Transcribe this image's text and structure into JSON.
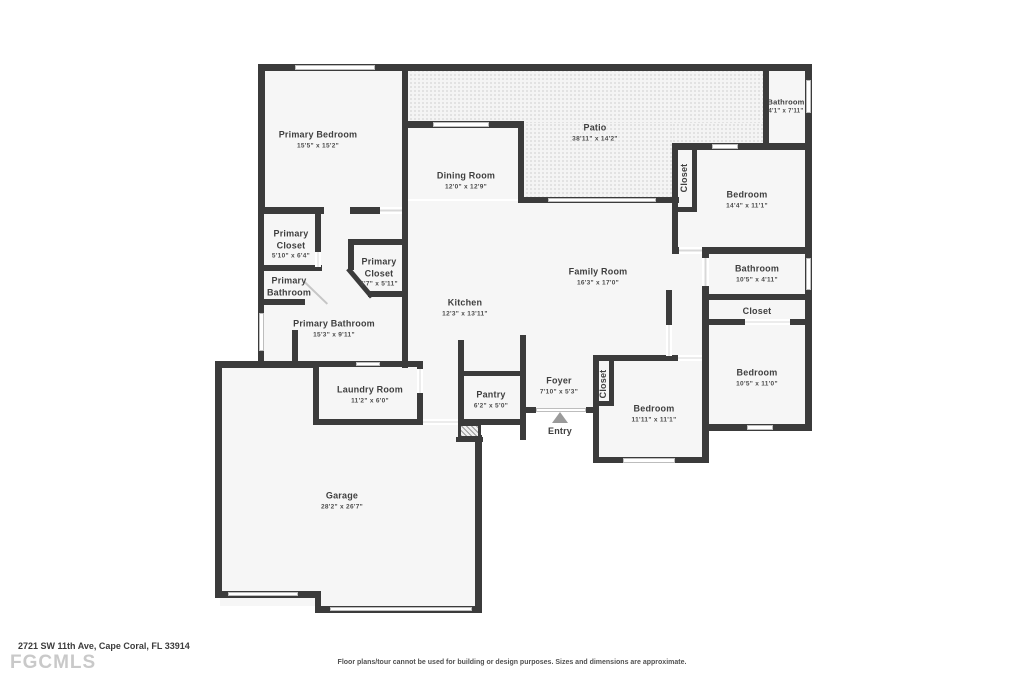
{
  "footer": {
    "address": "2721 SW 11th Ave, Cape Coral, FL 33914",
    "logo": "FGCMLS",
    "disclaimer": "Floor plans/tour cannot be used for building or design purposes. Sizes and dimensions are approximate."
  },
  "entry": {
    "label": "Entry"
  },
  "rooms": {
    "primary_bedroom": {
      "name": "Primary Bedroom",
      "dims": "15'5\" x 15'2\""
    },
    "patio": {
      "name": "Patio",
      "dims": "38'11\" x 14'2\""
    },
    "dining_room": {
      "name": "Dining Room",
      "dims": "12'0\" x 12'9\""
    },
    "bathroom_top_right": {
      "name": "Bathroom",
      "dims": "4'1\" x 7'11\""
    },
    "closet_top_right": {
      "name": "Closet"
    },
    "bedroom_top_right": {
      "name": "Bedroom",
      "dims": "14'4\" x 11'1\""
    },
    "family_room": {
      "name": "Family Room",
      "dims": "16'3\" x 17'0\""
    },
    "bathroom_right": {
      "name": "Bathroom",
      "dims": "10'5\" x 4'11\""
    },
    "closet_right": {
      "name": "Closet"
    },
    "bedroom_right": {
      "name": "Bedroom",
      "dims": "10'5\" x 11'0\""
    },
    "kitchen": {
      "name": "Kitchen",
      "dims": "12'3\" x 13'11\""
    },
    "primary_closet_left": {
      "name": "Primary Closet",
      "dims": "5'10\" x 6'4\""
    },
    "primary_bathroom_wc": {
      "name": "Primary Bathroom"
    },
    "primary_closet_right": {
      "name": "Primary Closet",
      "dims": "5'7\" x 5'11\""
    },
    "primary_bathroom": {
      "name": "Primary Bathroom",
      "dims": "15'3\" x 9'11\""
    },
    "laundry_room": {
      "name": "Laundry Room",
      "dims": "11'2\" x 6'0\""
    },
    "pantry": {
      "name": "Pantry",
      "dims": "6'2\" x 5'0\""
    },
    "foyer": {
      "name": "Foyer",
      "dims": "7'10\" x 5'3\""
    },
    "closet_foyer": {
      "name": "Closet"
    },
    "bedroom_bottom": {
      "name": "Bedroom",
      "dims": "11'11\" x 11'1\""
    },
    "garage": {
      "name": "Garage",
      "dims": "28'2\" x 26'7\""
    }
  }
}
